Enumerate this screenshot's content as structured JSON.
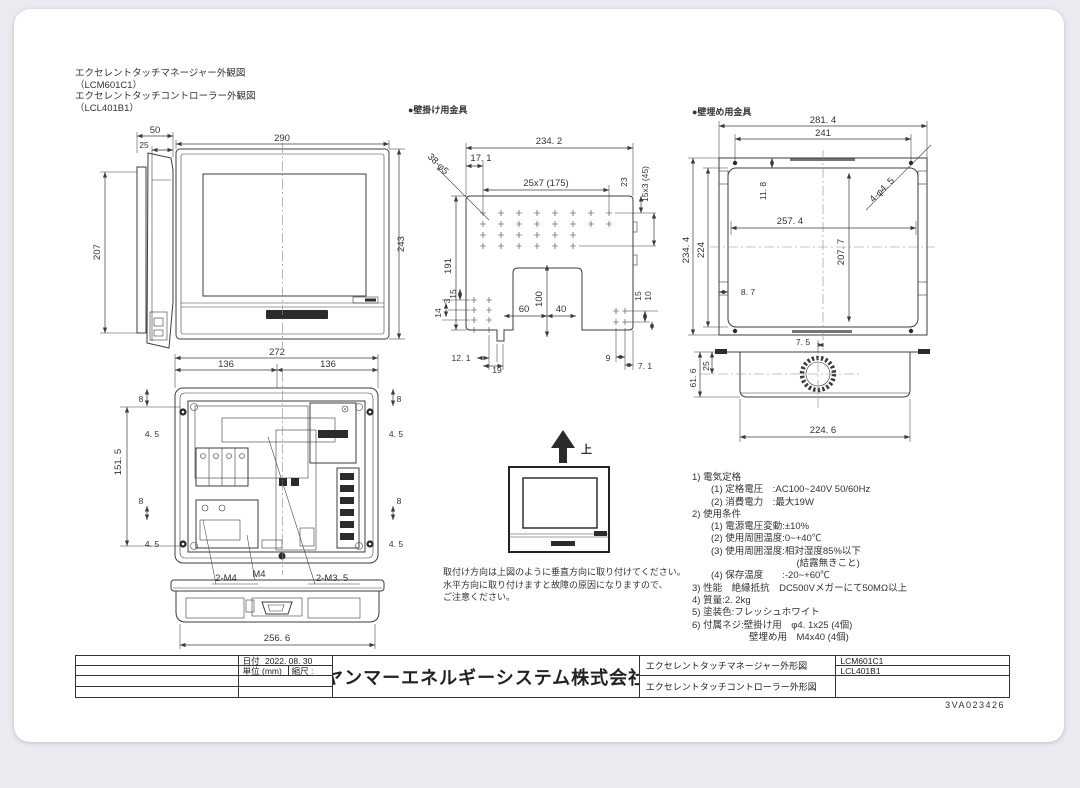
{
  "page": {
    "doc_number": "3VA023426"
  },
  "header": {
    "line1": "エクセレントタッチマネージャー外観図",
    "code1": "（LCM601C1）",
    "line2": "エクセレントタッチコントローラー外観図",
    "code2": "（LCL401B1）"
  },
  "labels": {
    "wall_mount": "●壁掛け用金具",
    "wall_embed": "●壁埋め用金具",
    "up": "上"
  },
  "note": {
    "line1": "取付け方向は上図のように垂直方向に取り付けてください。",
    "line2": "水平方向に取り付けますと故障の原因になりますので、",
    "line3": "ご注意ください。"
  },
  "specs": {
    "lines": [
      "1) 電気定格",
      "　　(1) 定格電圧　:AC100~240V 50/60Hz",
      "　　(2) 消費電力　:最大19W",
      "2) 使用条件",
      "　　(1) 電源電圧変動:±10%",
      "　　(2) 使用周囲温度:0~+40℃",
      "　　(3) 使用周囲湿度:相対湿度85%以下",
      "　　　　　　　　　　　(結露無きこと)",
      "　　(4) 保存温度　　:-20~+60℃",
      "3) 性能　絶縁抵抗　DC500Vメガーにて50MΩ以上",
      "4) 質量:2. 2kg",
      "5) 塗装色:フレッシュホワイト",
      "6) 付属ネジ:壁掛け用　φ4. 1x25 (4個)",
      "　　　　　　壁埋め用　M4x40 (4個)"
    ]
  },
  "title_block": {
    "date_label": "日付",
    "date_value": "2022. 08. 30",
    "unit_label": "単位 (mm)",
    "scale_label": "縮尺 :",
    "company": "ヤンマーエネルギーシステム株式会社",
    "drawing1": "エクセレントタッチマネージャー外形図",
    "drawing2": "エクセレントタッチコントローラー外形図",
    "model1": "LCM601C1",
    "model2": "LCL401B1"
  },
  "dims": {
    "front_w": "290",
    "front_h": "243",
    "side_d": "50",
    "side_b": "25",
    "side_h": "207",
    "rear_w": "272",
    "rear_l": "136",
    "rear_r": "136",
    "rear_h": "151. 5",
    "r8a": "8",
    "r45a": "4. 5",
    "r8b": "8",
    "r45b": "4. 5",
    "r8c": "8",
    "r45c": "4. 5",
    "r8d": "8",
    "r45d": "4. 5",
    "rear_bw": "256. 6",
    "m4a": "2-M4",
    "m4b": "M4",
    "m35": "2-M3. 5",
    "br_w": "234. 2",
    "br_off": "17. 1",
    "br_pitch": "25x7 (175)",
    "br_23": "23",
    "br_vp": "15x3 (45)",
    "br_holes": "38-φ5",
    "br_h": "191",
    "br_100": "100",
    "br_60": "60",
    "br_40": "40",
    "br_15": "15",
    "br_3": "3",
    "br_14": "14",
    "br_121": "12. 1",
    "br_19": "19",
    "br_9": "9",
    "br_71": "7. 1",
    "br_15r": "15",
    "br_10r": "10",
    "em_w": "281. 4",
    "em_iw": "241",
    "em_h": "234. 4",
    "em_ih": "224",
    "em_118": "11. 8",
    "em_mw": "257. 4",
    "em_mh": "207. 7",
    "em_holes": "4-φ4. 5",
    "em_87": "8. 7",
    "em_75": "7. 5",
    "es_616": "61. 6",
    "es_25": "25",
    "es_w": "224. 6"
  }
}
